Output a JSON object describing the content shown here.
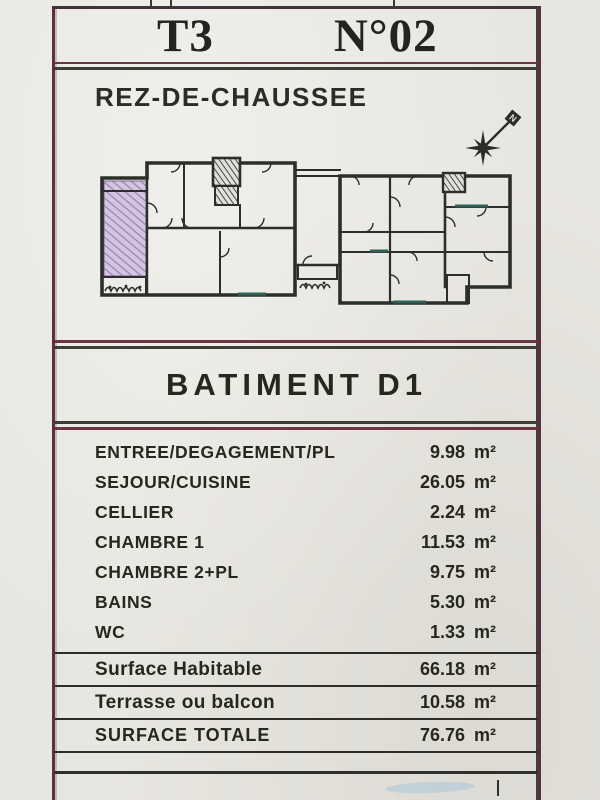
{
  "page": {
    "unit_type": "T3",
    "unit_number": "N°02",
    "floor_label": "REZ-DE-CHAUSSEE",
    "building_label": "BATIMENT D1",
    "compass_label": "N"
  },
  "areas": {
    "unit": "m²",
    "rooms": [
      {
        "label": "ENTREE/DEGAGEMENT/PL",
        "value": "9.98"
      },
      {
        "label": "SEJOUR/CUISINE",
        "value": "26.05"
      },
      {
        "label": "CELLIER",
        "value": "2.24"
      },
      {
        "label": "CHAMBRE 1",
        "value": "11.53"
      },
      {
        "label": "CHAMBRE 2+PL",
        "value": "9.75"
      },
      {
        "label": "BAINS",
        "value": "5.30"
      },
      {
        "label": "WC",
        "value": "1.33"
      }
    ],
    "totals": [
      {
        "label": "Surface Habitable",
        "value": "66.18"
      },
      {
        "label": "Terrasse ou balcon",
        "value": "10.58"
      },
      {
        "label": "SURFACE TOTALE",
        "value": "76.76"
      }
    ]
  },
  "colors": {
    "paper": "#e8e6e0",
    "frame_maroon": "#5a3043",
    "ink": "#26271f",
    "rule_dark": "#3c3e36",
    "highlight_purple": "#c4b4d2",
    "window_teal": "#2f6057",
    "smudge_blue": "#a9c6da"
  }
}
